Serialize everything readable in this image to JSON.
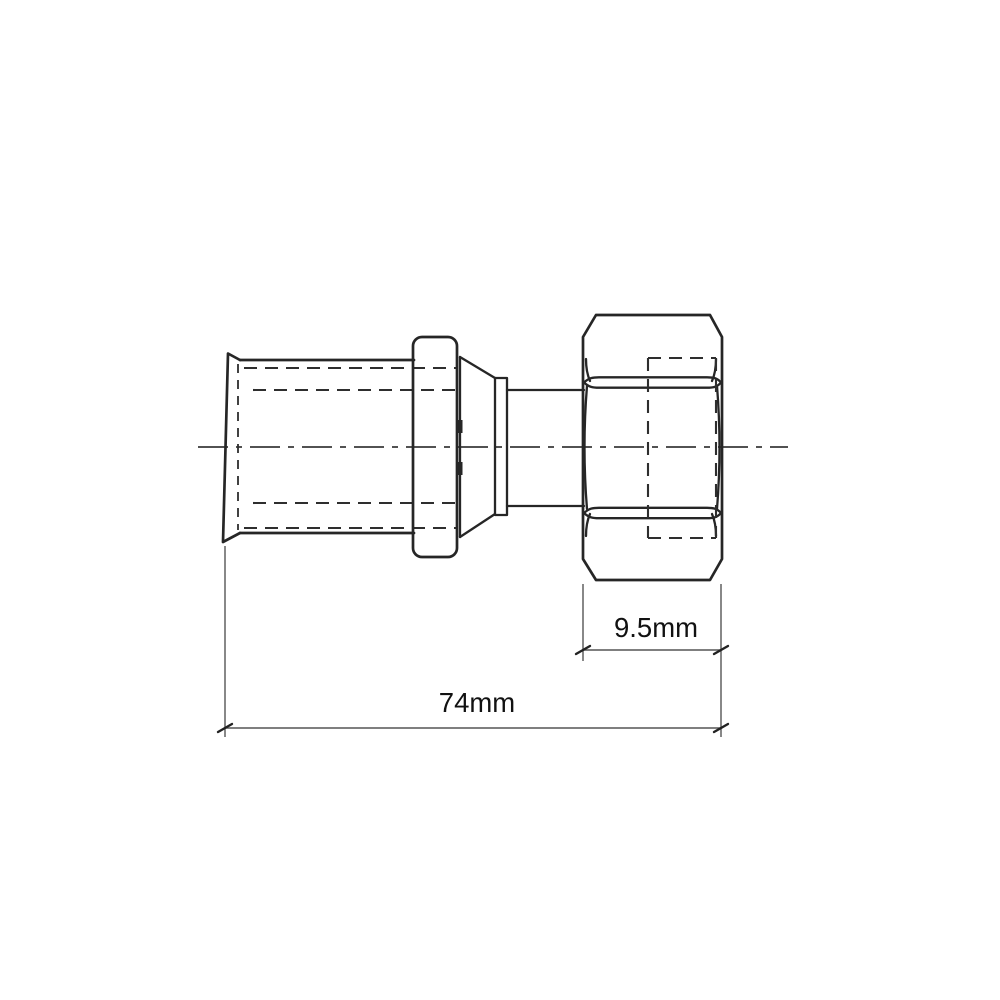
{
  "drawing": {
    "type": "technical-line-drawing",
    "subject": "Pipe press fitting with hex swivel nut, side elevation",
    "view": "side",
    "background_color": "#ffffff",
    "line_color": "#262626",
    "dimension_line_color": "#555555",
    "text_color": "#111111",
    "dimensions": {
      "nut_width": {
        "label": "9.5mm",
        "value": 9.5,
        "unit": "mm"
      },
      "overall_length": {
        "label": "74mm",
        "value": 74,
        "unit": "mm"
      }
    },
    "parts": [
      "press-sleeve with flared lip",
      "press collar ring",
      "compression cone",
      "step ring",
      "neck",
      "hex swivel nut"
    ]
  }
}
